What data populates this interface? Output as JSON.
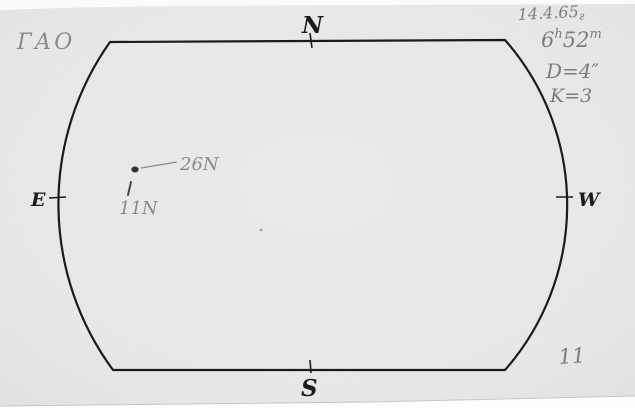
{
  "header": {
    "observatory": "ГАО",
    "date_main": "14.4.65",
    "date_year_suffix": "г"
  },
  "observation": {
    "time": {
      "hours": "6",
      "hours_unit": "h",
      "minutes": "52",
      "minutes_unit": "m"
    },
    "aperture": "D=4″",
    "quality": "K=3",
    "sheet_number": "11"
  },
  "compass": {
    "north": "N",
    "south": "S",
    "east": "E",
    "west": "W"
  },
  "spots": {
    "group_label": "26N",
    "secondary_label": "11N"
  },
  "colors": {
    "ink": "#1b1b1b",
    "pencil": "#8a8a8a",
    "paper": "#e9e9e7"
  }
}
